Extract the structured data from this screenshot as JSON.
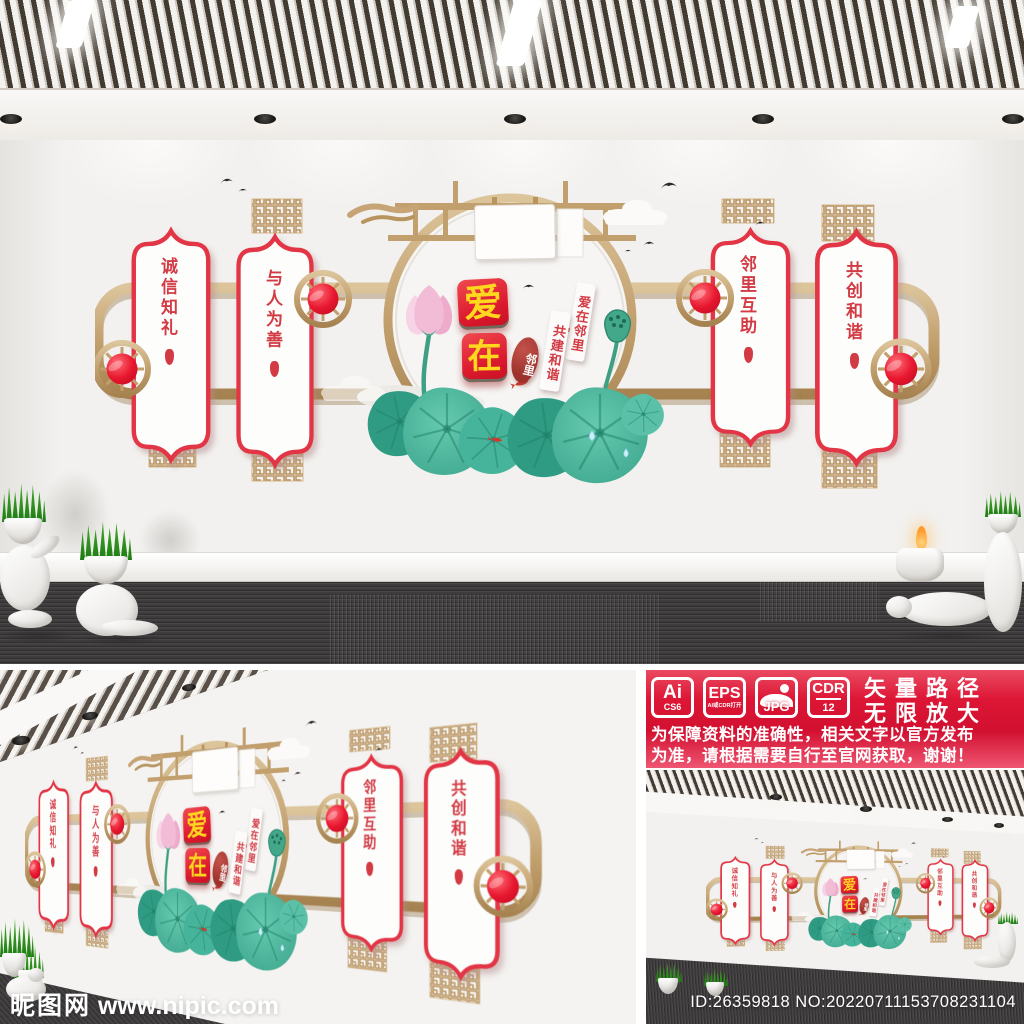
{
  "meta": {
    "site_watermark": "昵图网",
    "site_url": " www.nipic.com",
    "photo_id": "ID:26359818 NO:20220711153708231104"
  },
  "wall": {
    "panels": [
      {
        "label": "诚信知礼"
      },
      {
        "label": "与人为善"
      },
      {
        "label": "邻里互助"
      },
      {
        "label": "共创和谐"
      }
    ],
    "center_title": {
      "char1": "爱",
      "char2": "在"
    },
    "seal_text": "邻里",
    "side_strips": [
      {
        "label": "爱在邻里"
      },
      {
        "label": "共建和谐"
      }
    ]
  },
  "banner": {
    "formats": [
      {
        "name": "Ai",
        "sub": "CS6"
      },
      {
        "name": "EPS",
        "sub": "AI或CDR打开"
      },
      {
        "name": "JPG",
        "sub": ""
      },
      {
        "name": "CDR",
        "sub": "12"
      }
    ],
    "slogan": {
      "line1": "矢量路径",
      "line2": "无限放大"
    },
    "disclaimer": {
      "line1": "为保障资料的准确性，相关文字以官方发布",
      "line2": "为准，请根据需要自行至官网获取，谢谢！"
    }
  },
  "colors": {
    "accent_red": "#e23544",
    "deep_red": "#cf1230",
    "gold": "#c6a476",
    "teal_green": "#47b299",
    "lotus_pink": "#f2bcd7",
    "title_yellow": "#ffd71e",
    "seal_red": "#9c322b",
    "wall_white": "#f2f1ef",
    "carpet_dark": "#3b3839"
  }
}
